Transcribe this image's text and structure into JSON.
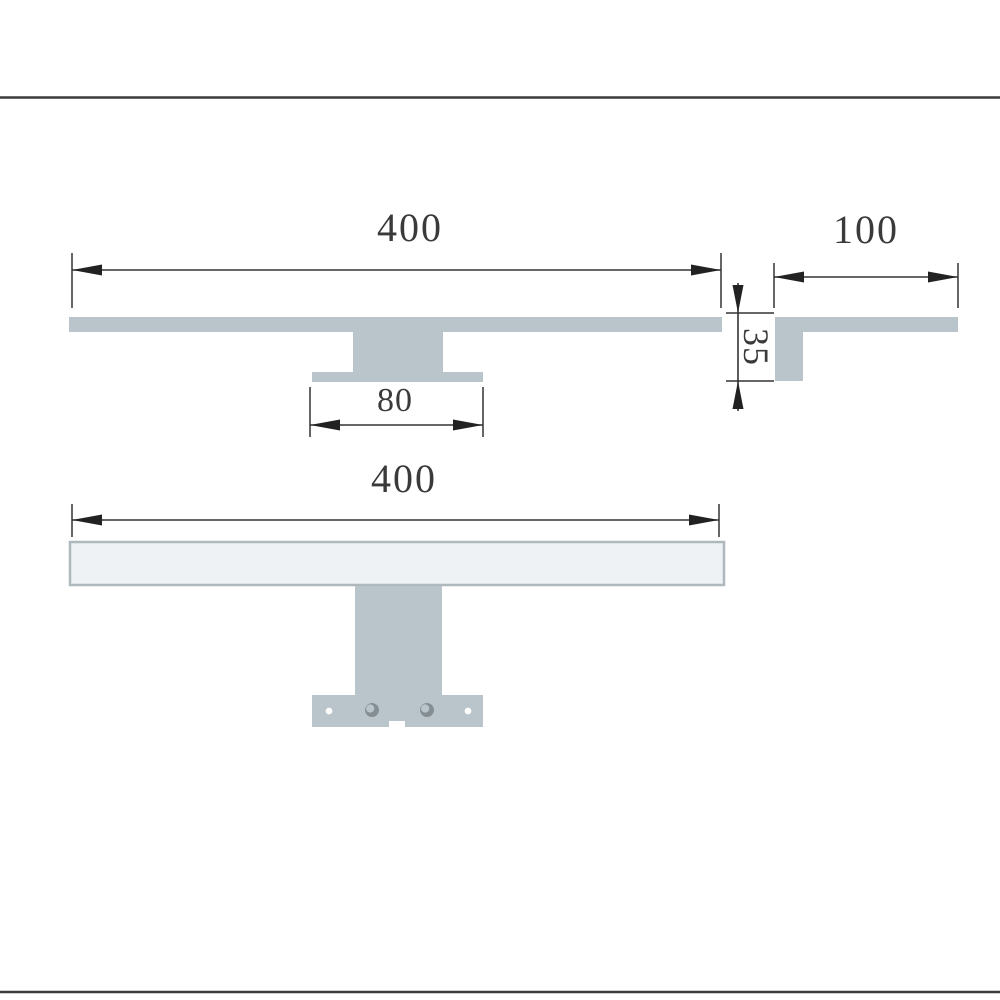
{
  "frame": {
    "rule_color": "#3b3b3b"
  },
  "drawing": {
    "line_color": "#333333",
    "text_color": "#3a3a3a",
    "profile_fill": "#bac5cb",
    "lamp_face_fill": "#eef2f4",
    "lamp_face_border": "#afb8bd",
    "slot_fill": "#848e93",
    "hole_fill": "#fdfdfd",
    "labels": {
      "side_width": "400",
      "end_depth": "100",
      "height": "35",
      "bracket_width": "80",
      "front_width": "400"
    }
  }
}
